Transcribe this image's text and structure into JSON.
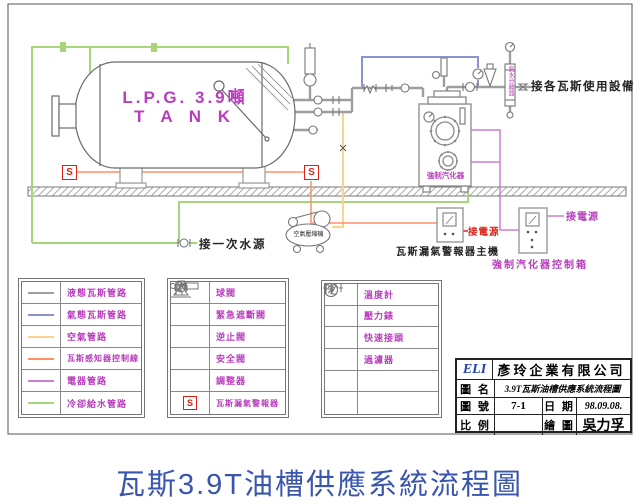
{
  "tank": {
    "line1": "L.P.G. 3.9噸",
    "line2": "T A N K"
  },
  "labels": {
    "water_source": "接一次水源",
    "gas_equipment": "接各瓦斯使用設備",
    "compressor": "空氣壓縮機",
    "vaporizer": "強制汽化器",
    "alarm_main": "瓦斯漏氣警報器主機",
    "vaporizer_control_box": "強制汽化器控制箱",
    "power_red": "接電源",
    "power_magenta": "接電源",
    "separator": "氣水分離器",
    "sensor_s": "S"
  },
  "legend_pipes": {
    "rows": [
      {
        "label": "液態瓦斯管路",
        "color": "#9e9e9e"
      },
      {
        "label": "氣態瓦斯管路",
        "color": "#8a93cd"
      },
      {
        "label": "空氣管路",
        "color": "#fcd38c"
      },
      {
        "label": "瓦斯感知器控制線",
        "color": "#ff9166"
      },
      {
        "label": "電器管路",
        "color": "#cc7fd4"
      },
      {
        "label": "冷卻給水管路",
        "color": "#a8d47a"
      }
    ]
  },
  "legend_valves": {
    "rows": [
      {
        "symbol": "ball-valve",
        "label": "球閥"
      },
      {
        "symbol": "emergency-shutoff-valve",
        "label": "緊急遮斷閥"
      },
      {
        "symbol": "check-valve",
        "label": "逆止閥"
      },
      {
        "symbol": "safety-valve",
        "label": "安全閥"
      },
      {
        "symbol": "regulator",
        "label": "調整器"
      },
      {
        "symbol": "gas-leak-alarm",
        "label": "瓦斯漏氣警報器"
      }
    ]
  },
  "legend_instruments": {
    "rows": [
      {
        "symbol": "thermometer",
        "label": "溫度計"
      },
      {
        "symbol": "pressure-gauge",
        "label": "壓力錶"
      },
      {
        "symbol": "quick-coupling",
        "label": "快速接頭"
      },
      {
        "symbol": "filter",
        "label": "過濾器"
      },
      {
        "symbol": "",
        "label": ""
      },
      {
        "symbol": "",
        "label": ""
      }
    ]
  },
  "title_block": {
    "logo": "ELI",
    "company": "彥玲企業有限公司",
    "field_drawing_name": "圖 名",
    "drawing_name": "3.9T瓦斯油槽供應系統流程圖",
    "field_drawing_no": "圖 號",
    "drawing_no": "7-1",
    "field_date": "日 期",
    "date": "98.09.08.",
    "field_scale": "比 例",
    "scale": "",
    "field_drawn_by": "繪 圖",
    "drawn_by": "吳力孚"
  },
  "caption": "瓦斯3.9T油槽供應系統流程圖",
  "colors": {
    "liquid_pipe": "#9e9e9e",
    "gas_pipe": "#8a93cd",
    "air_pipe": "#fcd38c",
    "sensor_line": "#ff9166",
    "electric_line": "#cc7fd4",
    "cooling_line": "#a8d47a",
    "label_magenta": "#b93dbd",
    "power_red": "#e02015",
    "caption_blue": "#3a55ae"
  }
}
